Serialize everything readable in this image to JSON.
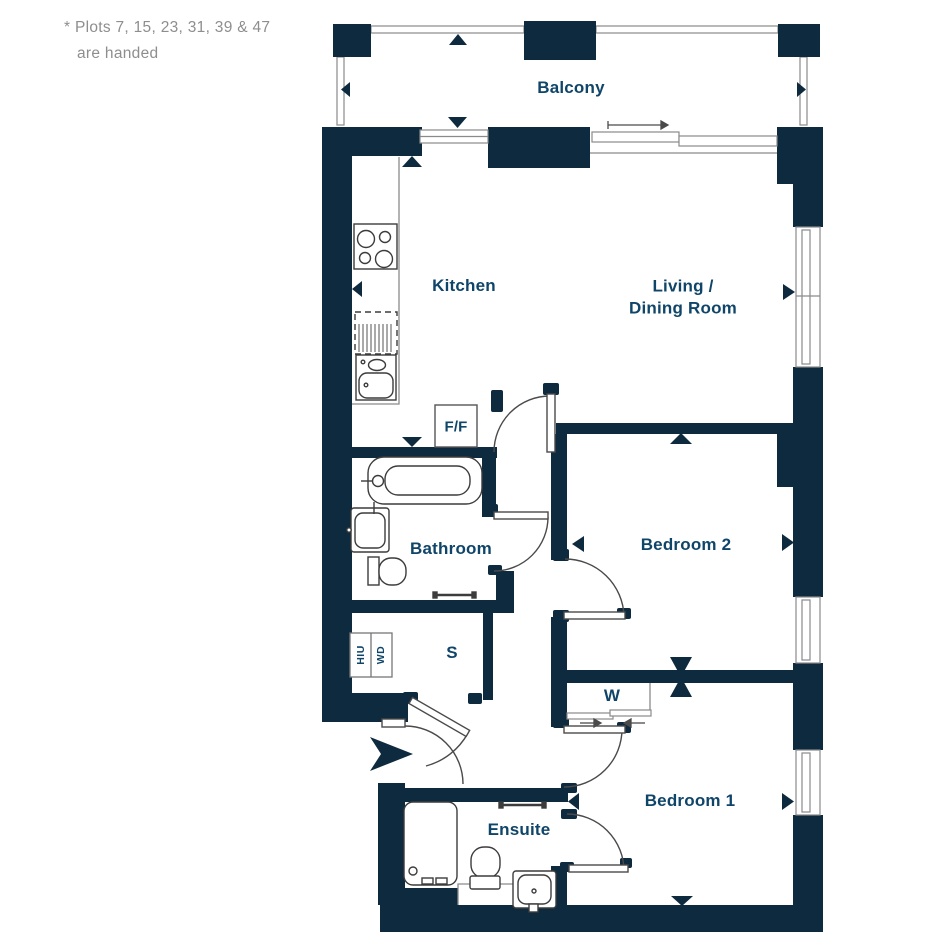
{
  "note": {
    "line1": "* Plots 7, 15, 23, 31, 39 & 47",
    "line2": "are handed"
  },
  "plan": {
    "balcony": "Balcony",
    "kitchen": "Kitchen",
    "living_line1": "Living /",
    "living_line2": "Dining Room",
    "bathroom": "Bathroom",
    "bedroom2": "Bedroom 2",
    "bedroom1": "Bedroom 1",
    "ensuite": "Ensuite",
    "store": "S",
    "wardrobe": "W",
    "fridge_freezer": "F/F",
    "hiu": "HIU",
    "washer_dryer": "WD"
  },
  "colors": {
    "wall": "#0e2a3e",
    "label": "#0f4569",
    "line": "#8a8a8a",
    "note_text": "#8e8e8e",
    "background": "#ffffff"
  }
}
